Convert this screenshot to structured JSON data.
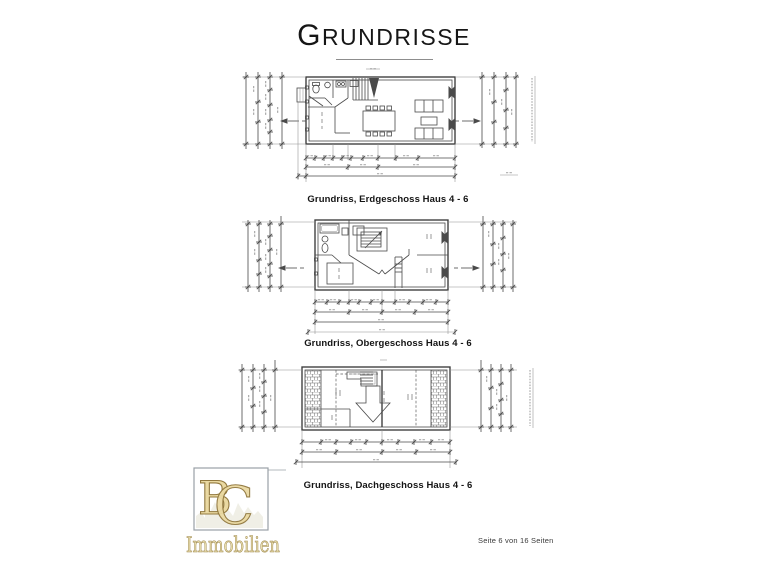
{
  "page": {
    "background": "#ffffff",
    "title": {
      "text": "Grundrisse",
      "display_initial": "G",
      "display_rest": "RUNDRISSE"
    },
    "footer": {
      "page_indicator": "Seite 6 von 16 Seiten"
    }
  },
  "floorplans": [
    {
      "name": "Erdgeschoss",
      "caption": "Grundriss, Erdgeschoss  Haus 4 - 6"
    },
    {
      "name": "Obergeschoss",
      "caption": "Grundriss, Obergeschoss Haus 4 - 6"
    },
    {
      "name": "Dachgeschoss",
      "caption": "Grundriss, Dachgeschoss Haus 4 - 6"
    }
  ],
  "logo": {
    "monogram_b": "B",
    "monogram_c": "C",
    "wordmark": "Immobilien",
    "colors": {
      "gold_fill": "#ead9a2",
      "gold_stroke": "#92793f",
      "frame": "#9aa0a6"
    }
  },
  "drawing": {
    "ink_color": "#4a4a4a",
    "paper_color": "#ffffff"
  }
}
